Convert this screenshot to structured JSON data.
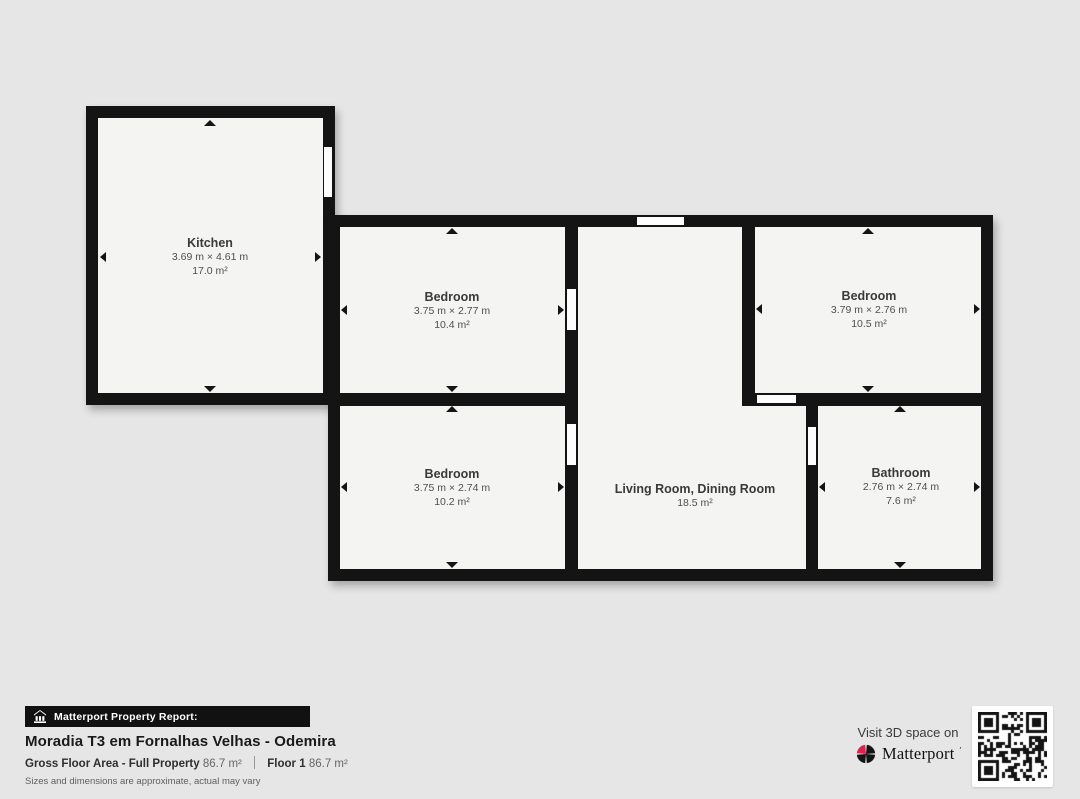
{
  "plan": {
    "rooms": [
      {
        "id": "kitchen",
        "name": "Kitchen",
        "dimensions": "3.69 m × 4.61 m",
        "area": "17.0 m²"
      },
      {
        "id": "bedroom-top-middle",
        "name": "Bedroom",
        "dimensions": "3.75 m × 2.77 m",
        "area": "10.4 m²"
      },
      {
        "id": "bedroom-top-right",
        "name": "Bedroom",
        "dimensions": "3.79 m × 2.76 m",
        "area": "10.5 m²"
      },
      {
        "id": "bedroom-bottom-middle",
        "name": "Bedroom",
        "dimensions": "3.75 m × 2.74 m",
        "area": "10.2 m²"
      },
      {
        "id": "living-dining",
        "name": "Living Room, Dining Room",
        "area": "18.5 m²"
      },
      {
        "id": "bathroom",
        "name": "Bathroom",
        "dimensions": "2.76 m × 2.74 m",
        "area": "7.6 m²"
      }
    ]
  },
  "footer": {
    "report_label": "Matterport Property Report:",
    "property_title": "Moradia T3 em Fornalhas Velhas - Odemira",
    "gross_floor_label": "Gross Floor Area - Full Property",
    "gross_floor_value": "86.7 m²",
    "floor_label": "Floor 1",
    "floor_value": "86.7 m²",
    "disclaimer": "Sizes and dimensions are approximate, actual may vary"
  },
  "cta": {
    "visit_text": "Visit 3D space on",
    "brand": "Matterport",
    "brand_mark": "′"
  },
  "colors": {
    "background": "#e6e6e6",
    "wall": "#141414",
    "floor": "#f4f4f3",
    "window_slot": "#fdfdfd",
    "bar_background": "#111111",
    "accent_red": "#e0234e"
  }
}
